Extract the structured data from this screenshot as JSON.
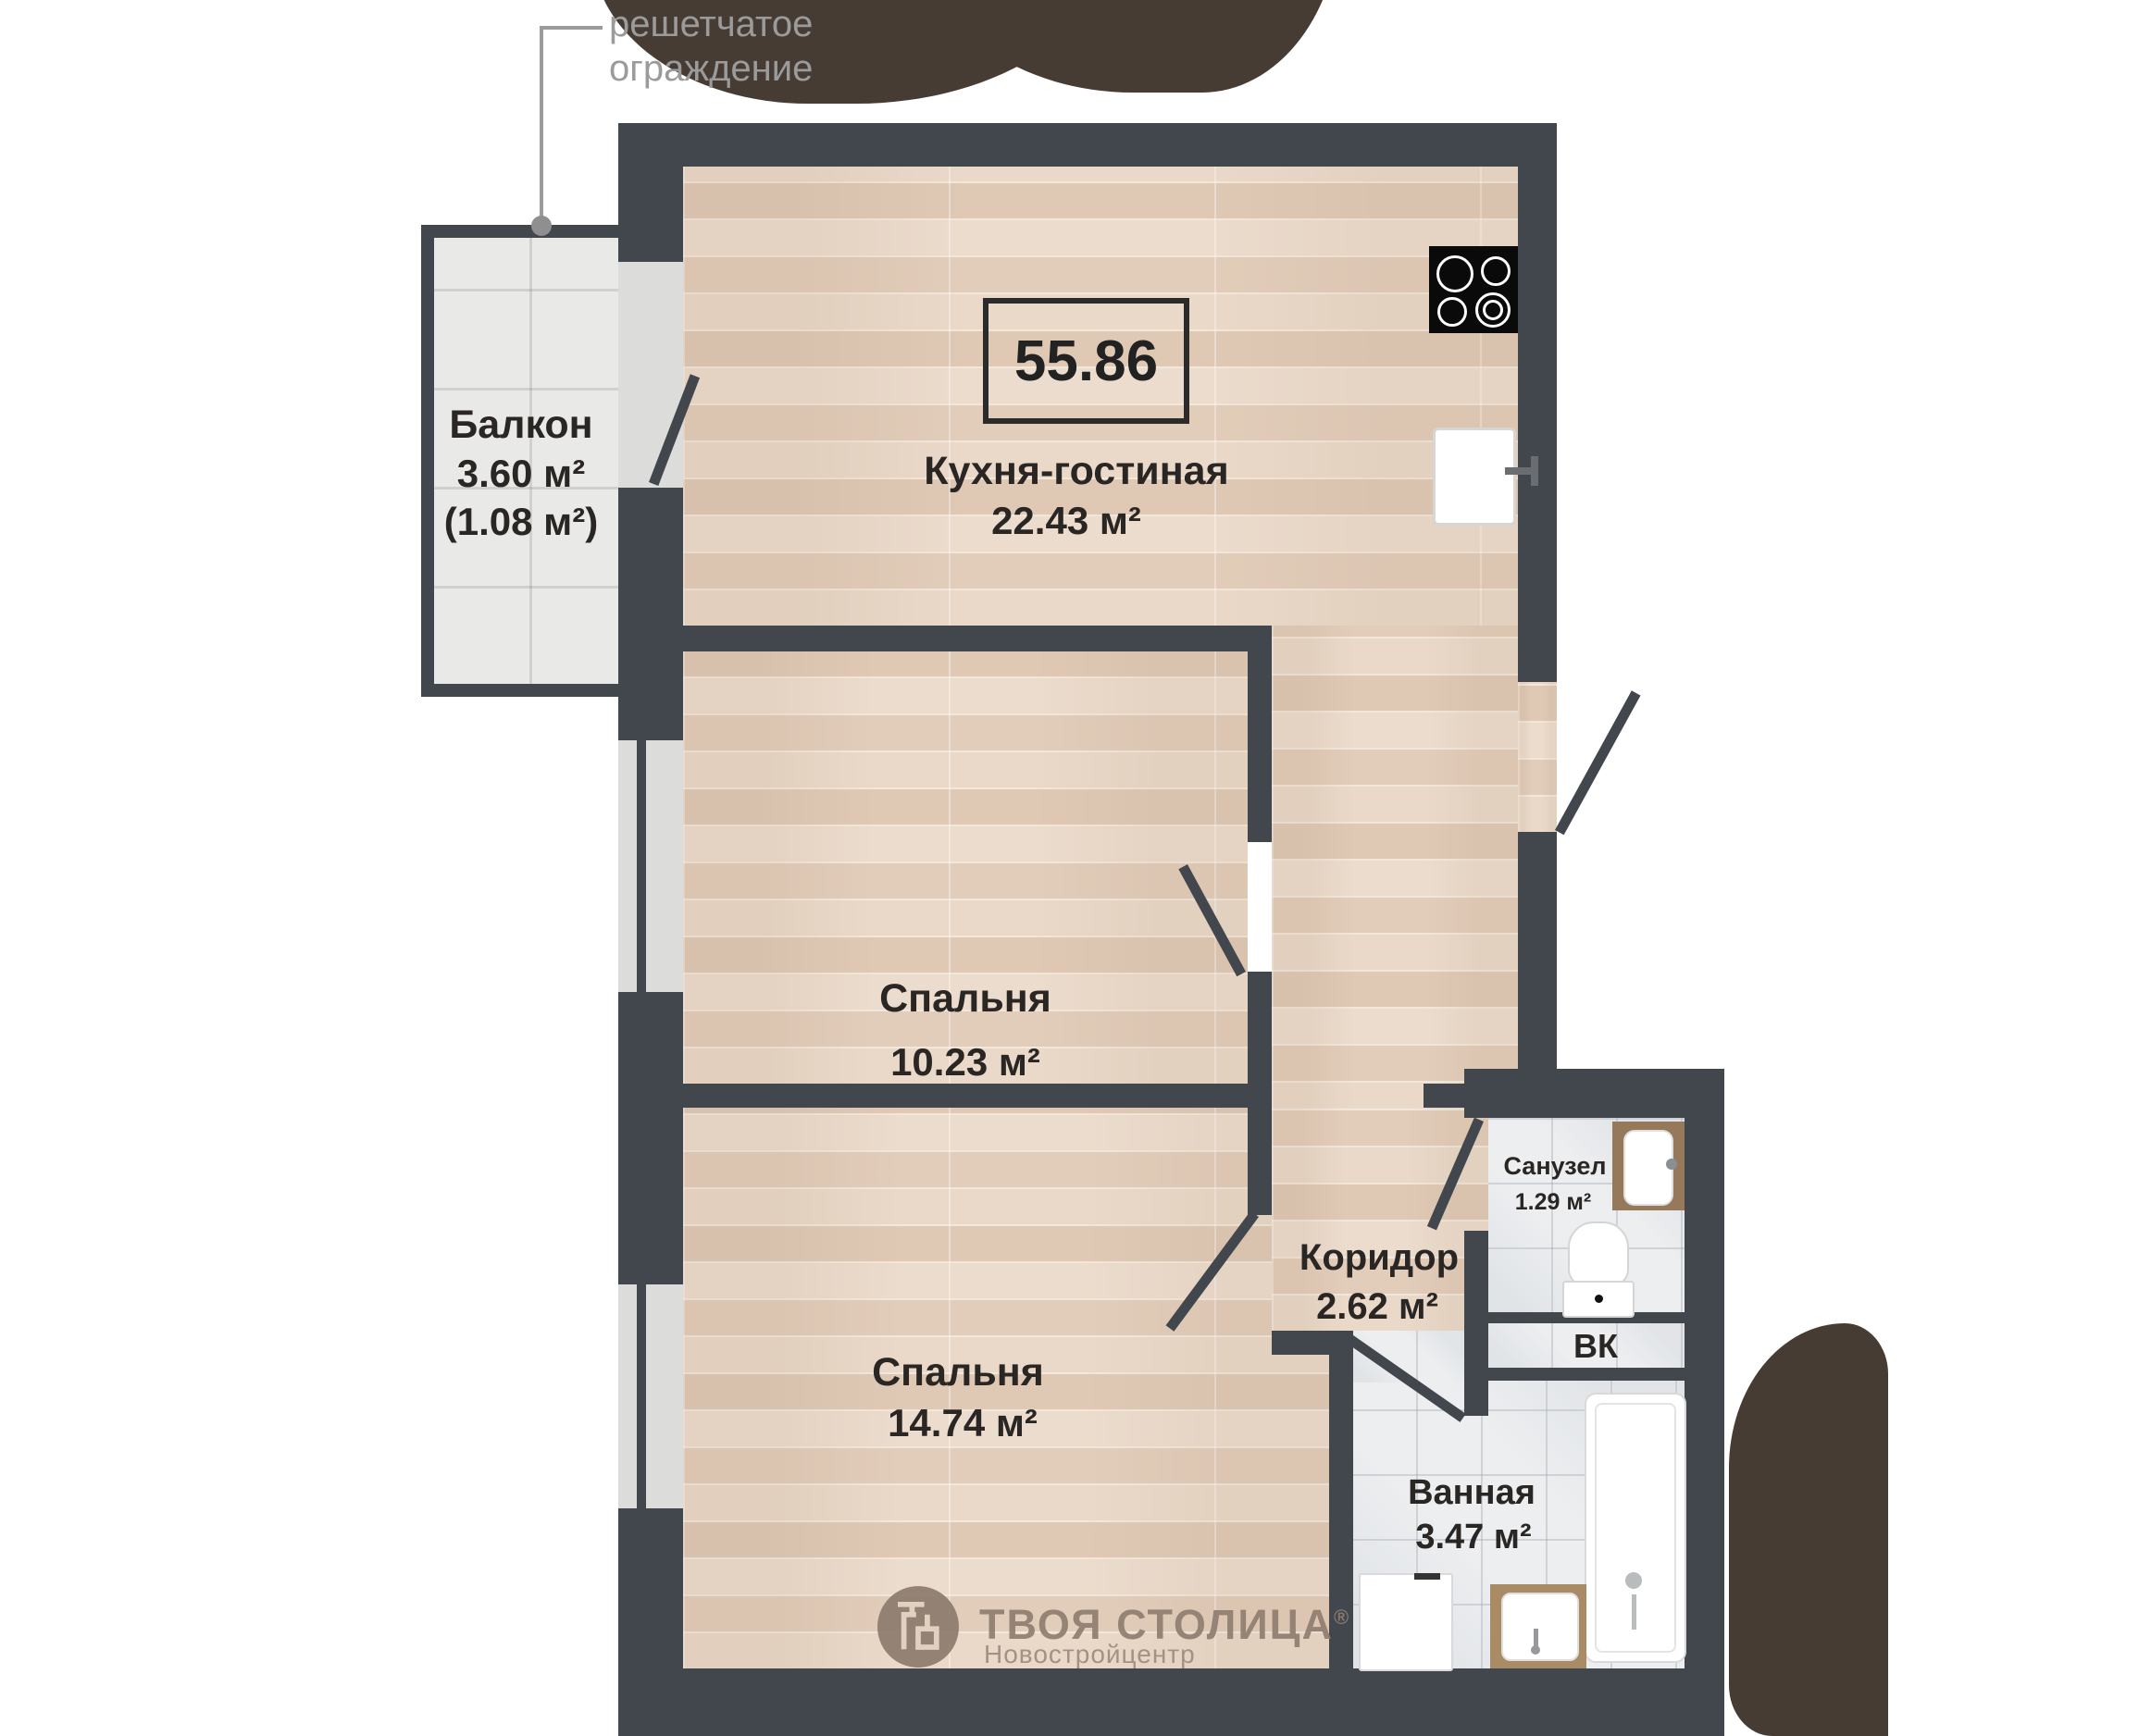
{
  "annotation": {
    "text": "решетчатое\nограждение"
  },
  "total_area": {
    "value": "55.86"
  },
  "rooms": {
    "balcony": {
      "name": "Балкон",
      "area": "3.60 м²",
      "area2": "(1.08 м²)"
    },
    "kitchen": {
      "name": "Кухня-гостиная",
      "area": "22.43 м²"
    },
    "bedroom1": {
      "name": "Спальня",
      "area": "10.23 м²"
    },
    "bedroom2": {
      "name": "Спальня",
      "area": "14.74 м²"
    },
    "corridor": {
      "name": "Коридор",
      "area": "2.62 м²"
    },
    "wc": {
      "name": "Санузел",
      "area": "1.29 м²"
    },
    "shaft": {
      "name": "ВК"
    },
    "bathroom": {
      "name": "Ванная",
      "area": "3.47 м²"
    }
  },
  "watermark": {
    "brand": "ТВОЯ СТОЛИЦА",
    "reg": "®",
    "sub": "Новостройцентр"
  },
  "colors": {
    "wall": "#42464d",
    "decor_blob": "#463c34",
    "wood_floor": "#e7d5c5",
    "tile_floor": "#eceef0",
    "balcony_tile": "#e9e9e7",
    "label_text": "#2a2624",
    "annotation_gray": "#9b9b9b",
    "logo_brown": "#8d7c6e",
    "stove_black": "#0a0a0a"
  }
}
